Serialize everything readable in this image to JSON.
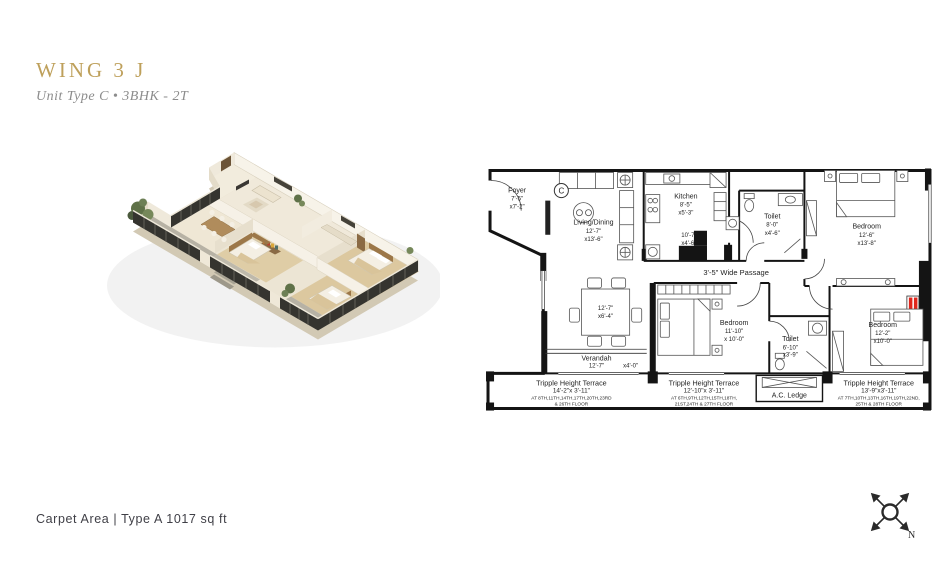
{
  "header": {
    "title": "WING 3 J",
    "subtitle": "Unit Type C • 3BHK - 2T"
  },
  "footer": {
    "carpet_area": "Carpet Area | Type A 1017 sq ft"
  },
  "compass": {
    "north_label": "N"
  },
  "colors": {
    "accent": "#BEA05B",
    "ink": "#1B1B1B",
    "red": "#E0261C",
    "muted": "#8C8C8C",
    "footer": "#3F3F46"
  },
  "plan": {
    "grid_marker": "C",
    "passage_label": "3'-5\" Wide Passage",
    "rooms": {
      "foyer": {
        "name": "Foyer",
        "d1": "7'-5\"",
        "d2": "x7'-2\""
      },
      "living_dining": {
        "name": "Living/Dining",
        "d1": "12'-7\"",
        "d2": "x13'-6\""
      },
      "kitchen": {
        "name": "Kitchen",
        "d1": "8'-5\"",
        "d2": "x5'-3\""
      },
      "kitchen_utility": {
        "d1": "10'-7\"",
        "d2": "x4'-6\""
      },
      "toilet_top": {
        "name": "Toilet",
        "d1": "8'-0\"",
        "d2": "x4'-6\""
      },
      "bedroom_top_right": {
        "name": "Bedroom",
        "d1": "12'-6\"",
        "d2": "x13'-8\""
      },
      "dining_nook": {
        "d1": "12'-7\"",
        "d2": "x6'-4\""
      },
      "verandah": {
        "name": "Verandah",
        "d1": "12'-7\"",
        "d2": "x4'-0\""
      },
      "bedroom_middle": {
        "name": "Bedroom",
        "d1": "11'-10\"",
        "d2": "x 10'-0\""
      },
      "toilet_bottom": {
        "name": "Toilet",
        "d1": "6'-10\"",
        "d2": "x3'-9\""
      },
      "bedroom_right": {
        "name": "Bedroom",
        "d1": "12'-2\"",
        "d2": "x10'-0\""
      },
      "ac_ledge": {
        "name": "A.C. Ledge"
      }
    },
    "terraces": [
      {
        "name": "Tripple Height Terrace",
        "dims": "14'-2\"x 3'-11\"",
        "floors_line1": "AT 8TH,11TH,14TH,17TH,20TH,23RD",
        "floors_line2": "& 26TH FLOOR"
      },
      {
        "name": "Tripple Height Terrace",
        "dims": "12'-10\"x 3'-11\"",
        "floors_line1": "AT 6TH,9TH,12TH,15TH,18TH,",
        "floors_line2": "21ST,24TH & 27TH FLOOR"
      },
      {
        "name": "Tripple Height Terrace",
        "dims": "13'-9\"x3'-11\"",
        "floors_line1": "AT 7TH,10TH,13TH,16TH,19TH,22ND,",
        "floors_line2": "25TH & 28TH FLOOR"
      }
    ]
  }
}
